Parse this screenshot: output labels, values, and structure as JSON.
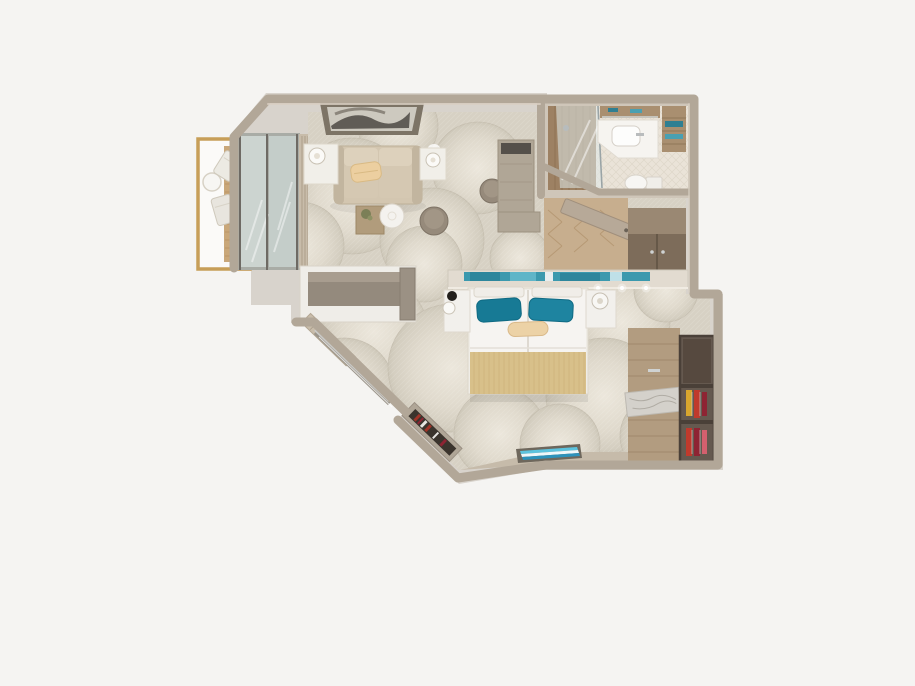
{
  "scene": {
    "kind": "floorplan-3d-render",
    "view": "top-down",
    "subject": "suite-cabin-floor-plan"
  },
  "palette": {
    "background": "#f5f4f2",
    "silhouette": "#d8d3cc",
    "wall": "#b2a798",
    "wallLight": "#cfc6b9",
    "carpetBase": "#d7d1c4",
    "carpetHi": "#ece7dc",
    "carpetLo": "#cdc7b8",
    "woodFloor": "#c7ae8e",
    "woodPlank": "#b3946f",
    "woodDeck": "#c9a779",
    "goldRail": "#c79e58",
    "glass": "#ccd4d0",
    "curtain": "#c8bcaa",
    "sofa": "#d3c6b0",
    "sofaDark": "#c2b59f",
    "creamPillow": "#eccfa0",
    "tableWhite": "#f4f2ee",
    "pouf": "#968a7b",
    "desk": "#b0a696",
    "tvDark": "#55504a",
    "consoleOuter": "#efede8",
    "consoleInner": "#948a7d",
    "headboardBand": "#e2dbd0",
    "artTeal": "#3b99ae",
    "pillowTeal": "#1e84a0",
    "pillowTealDark": "#177a95",
    "duvet": "#f6f4f1",
    "bolster": "#ecd2a6",
    "throwGold": "#d8c08a",
    "nightstand": "#f2f0ec",
    "wardrobeWood": "#7d6c5a",
    "wardrobeTop": "#9a8873",
    "closetWood": "#b29c80",
    "marble": "#d4d1cb",
    "shoeShelf": "#65594f",
    "shoeShelfDark": "#56493f",
    "shoeRed": "#c03a2c",
    "shoeYellow": "#d8a62e",
    "shoeCrimson": "#8e2433",
    "bathFloor": "#eae3d8",
    "bathWood": "#a98f70",
    "showerWood": "#9d8163",
    "vanity": "#f6f4f0",
    "towelTeal": "#2f7f92",
    "artFrame": "#7d7466",
    "artInner": "#cdc9bf",
    "artDark": "#54504a",
    "bottomArtCyan": "#5cc3de",
    "bottomArtBlue": "#2d92bb",
    "nicheDark": "#3b342d",
    "bookRed": "#a03428",
    "chrome": "#c9c9c6",
    "doorSlab": "#b7a998"
  },
  "regions": [
    {
      "name": "balcony"
    },
    {
      "name": "living-area"
    },
    {
      "name": "bathroom"
    },
    {
      "name": "entry-corridor"
    },
    {
      "name": "bedroom"
    },
    {
      "name": "closet-area"
    }
  ],
  "furniture": [
    "balcony-table-and-chairs",
    "wood-deck",
    "glass-balcony-doors",
    "sheer-curtain",
    "abstract-wall-art",
    "wall-sconces",
    "sofa",
    "cream-throw-pillow",
    "side-tables-with-lamps",
    "wood-cube-coffee-table",
    "round-coffee-table",
    "ottoman-poufs",
    "tv-dresser-unit",
    "vanity-stool",
    "shower",
    "vanity-sink",
    "toilet",
    "towel-shelf",
    "entry-door",
    "sliding-door-wardrobe",
    "divider-console",
    "headboard-art-ledge",
    "double-bed",
    "teal-accent-pillows",
    "bolster-pillow",
    "gold-bed-runner",
    "nightstands-with-lamps",
    "diagonal-window-rail",
    "pleated-curtain",
    "book-niche",
    "striped-bottom-wall-art",
    "closet-wardrobe-marble-inlay",
    "shoe-rack-with-shoes"
  ]
}
